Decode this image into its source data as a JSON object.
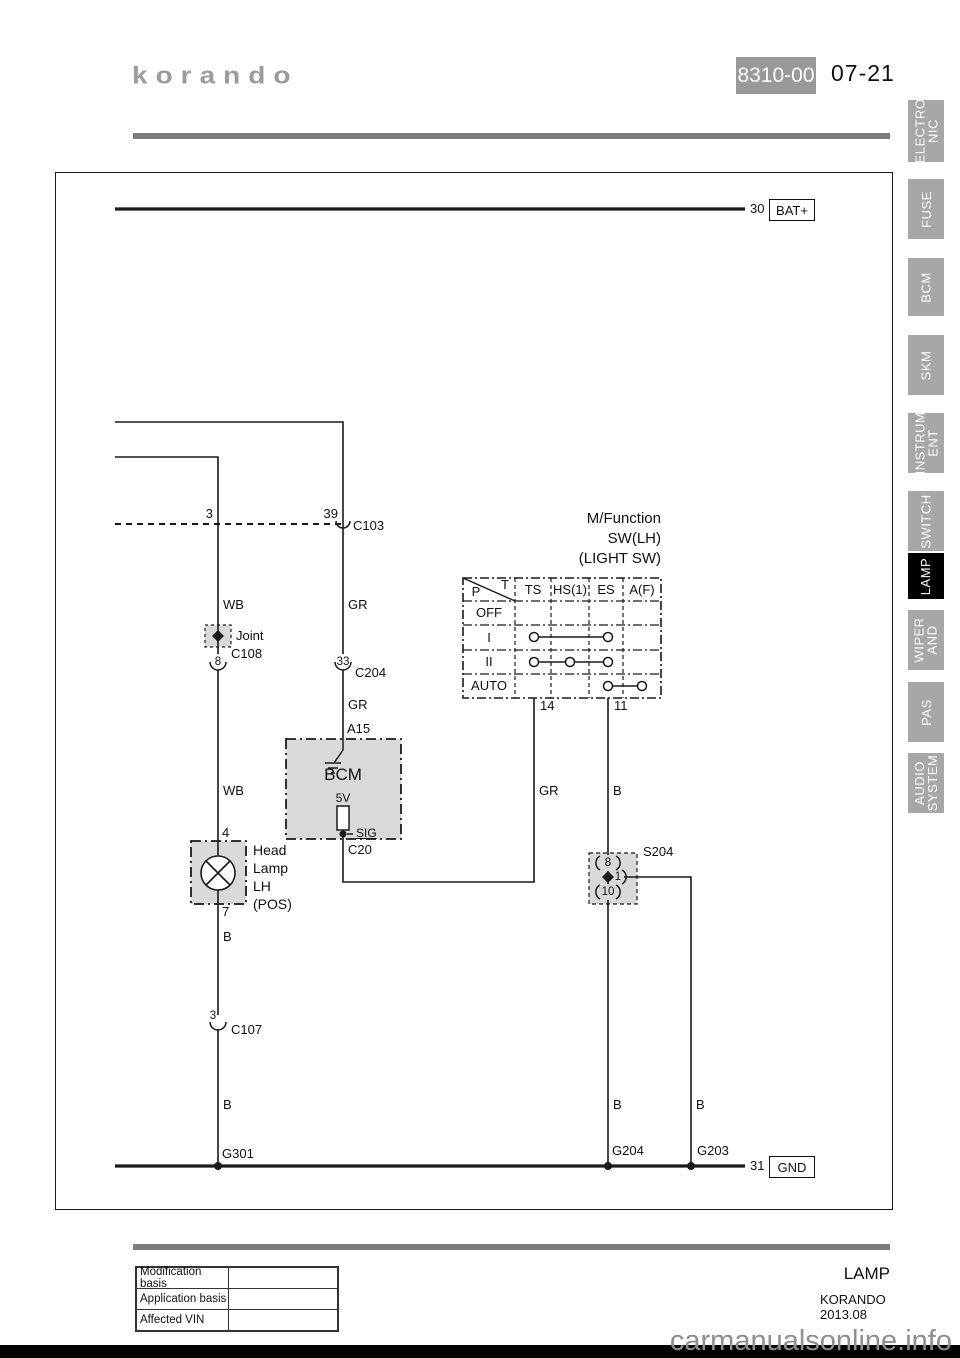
{
  "header": {
    "logo": "korando",
    "code": "8310-00",
    "page": "07-21"
  },
  "sidebar": {
    "tabs": [
      {
        "label": "ELECTRO\nNIC"
      },
      {
        "label": "FUSE"
      },
      {
        "label": "BCM"
      },
      {
        "label": "SKM"
      },
      {
        "label": "INSTRUM\nENT"
      },
      {
        "label": "SWITCH"
      },
      {
        "label": "LAMP"
      },
      {
        "label": "WIPER\nAND"
      },
      {
        "label": "PAS"
      },
      {
        "label": "AUDIO\nSYSTEM"
      }
    ]
  },
  "diagram": {
    "bat": {
      "wire_no": "30",
      "label": "BAT+"
    },
    "gnd": {
      "wire_no": "31",
      "label": "GND"
    },
    "wire_colors": {
      "wb": "WB",
      "gr": "GR",
      "b": "B"
    },
    "connectors": {
      "c103": "C103",
      "c108": "C108",
      "c204": "C204",
      "c107": "C107",
      "c20": "C20",
      "s204": "S204"
    },
    "pins": {
      "c103_a": "3",
      "c103_b": "39",
      "c108": "8",
      "c204": "33",
      "a15": "A15",
      "lamp_in": "4",
      "lamp_out": "7",
      "c107": "3",
      "sw_ts": "14",
      "sw_es": "11",
      "s204_in": "8",
      "s204_out": "1",
      "s204_down": "10"
    },
    "bcm": {
      "name": "BCM",
      "voltage": "5V",
      "signal": "SIG"
    },
    "joint_label": "Joint",
    "headlamp_label": "Head\nLamp\nLH\n(POS)",
    "light_switch": {
      "title": "M/Function\nSW(LH)\n(LIGHT SW)",
      "corner_p": "P",
      "corner_t": "T",
      "columns": [
        "TS",
        "HS(1)",
        "ES",
        "A(F)"
      ],
      "rows": [
        "OFF",
        "I",
        "II",
        "AUTO"
      ]
    },
    "grounds": {
      "g301": "G301",
      "g204": "G204",
      "g203": "G203"
    }
  },
  "footer": {
    "table_rows": [
      "Modification basis",
      "Application basis",
      "Affected VIN"
    ],
    "section": "LAMP",
    "model": "KORANDO 2013.08",
    "watermark": "carmanualsonline.info"
  },
  "colors": {
    "tab_gray": "#a7a7a7",
    "active_tab": "#000000",
    "box_gray": "#d9d9d9",
    "rule_gray": "#7d7d7d",
    "badge_gray": "#999999"
  }
}
